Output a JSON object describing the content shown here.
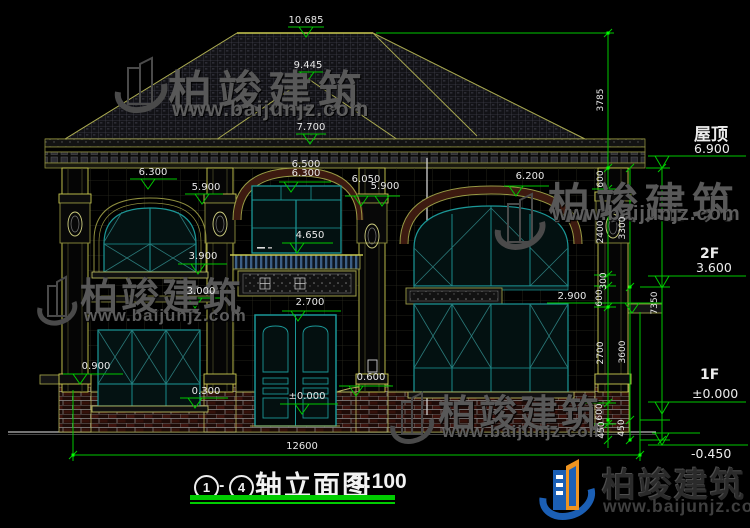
{
  "title": {
    "axis_from": "1",
    "dash": "-",
    "axis_to": "4",
    "text": "轴立面图",
    "scale": "1:100"
  },
  "dims": {
    "ridge": "10.685",
    "upper_hip": "9.445",
    "upper_eave": "7.700",
    "left_arch": "6.300",
    "left_spring": "5.900",
    "center_a": "6.500",
    "center_b": "6.300",
    "center_c": "6.050",
    "center_d": "5.900",
    "right_arch": "6.200",
    "balcony": "4.650",
    "left_sill_2f": "3.900",
    "left_band": "3.000",
    "right_band": "2.900",
    "door_top": "2.700",
    "left_sill_1f": "0.900",
    "left_low": "0.300",
    "plinth": "0.600",
    "door_floor": "±0.000",
    "total_width": "12600"
  },
  "levels": {
    "roof_label": "屋顶",
    "roof_value": "6.900",
    "f2_label": "2F",
    "f2_value": "3.600",
    "f1_label": "1F",
    "f1_value": "±0.000",
    "ground_value": "-0.450"
  },
  "chains": {
    "c1": [
      "3785",
      "600",
      "2400",
      "300",
      "600",
      "2700",
      "600",
      "450"
    ],
    "c2": [
      "3300",
      "3600",
      "450"
    ],
    "c3": [
      "7350"
    ]
  },
  "brand": {
    "name": "柏竣建筑",
    "url": "www.baijunjz.com"
  },
  "colors": {
    "dim_green": "#00c800",
    "frame_teal": "#1b9898",
    "outline_olive": "#8f8f3f",
    "brick_red": "#3d120c",
    "logo_blue": "#1b5fb5",
    "logo_orange": "#ef9420"
  }
}
